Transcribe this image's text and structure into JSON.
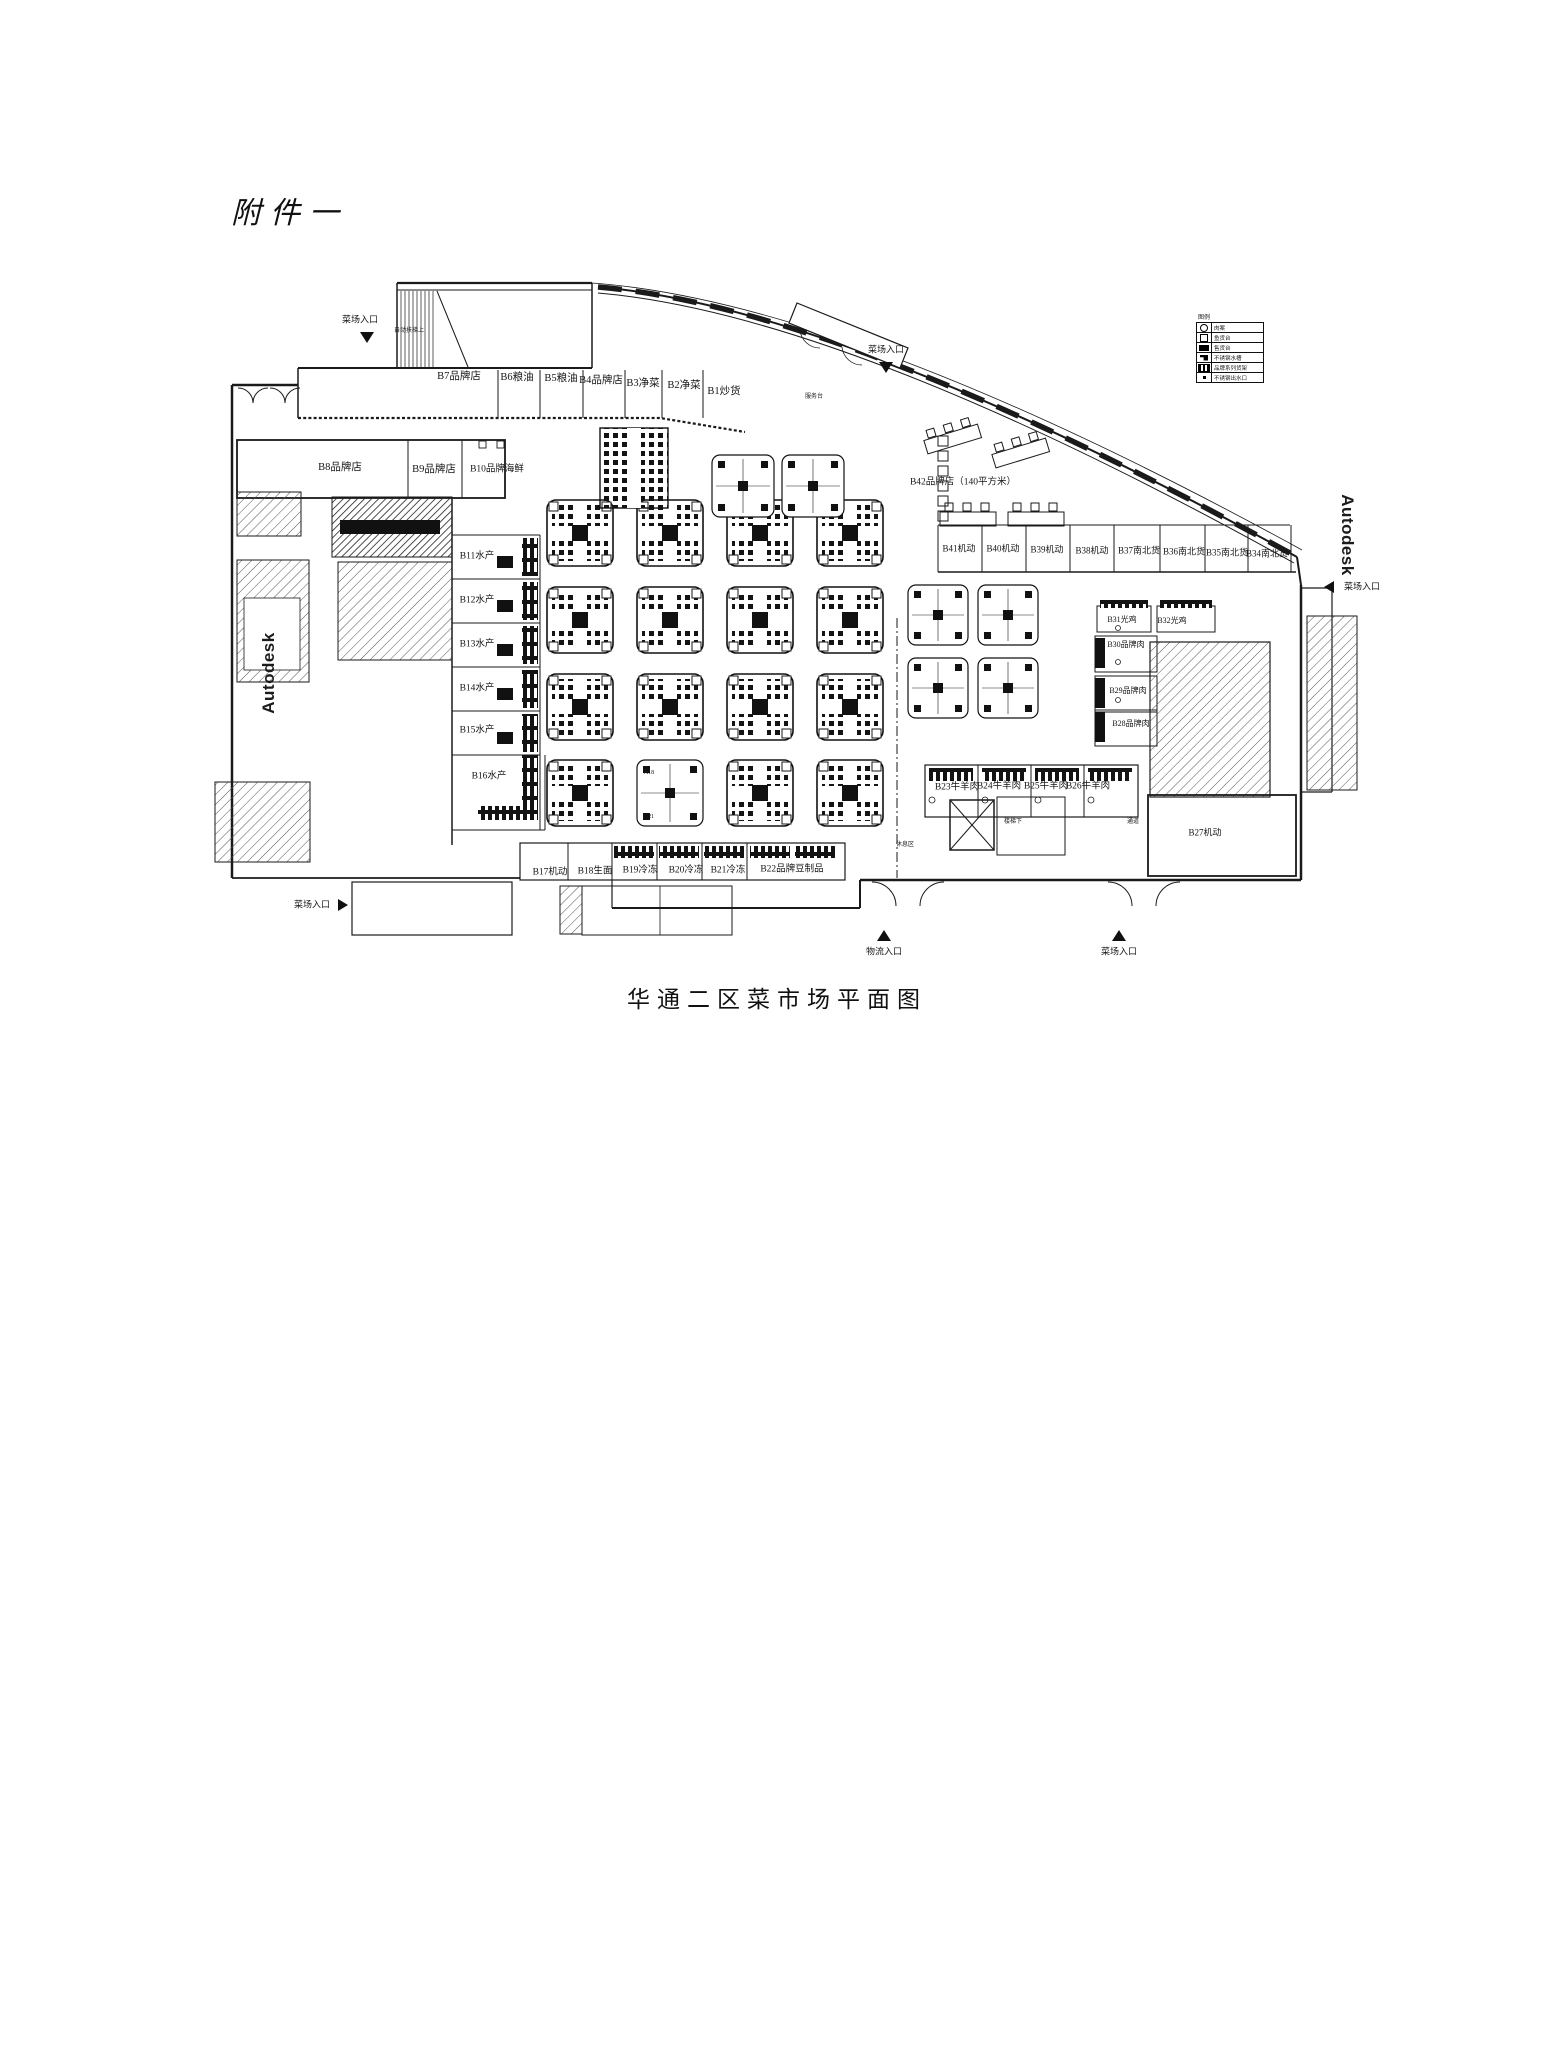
{
  "doc": {
    "attachment_label": "附件一",
    "caption": "华通二区菜市场平面图",
    "watermark": "Autodesk"
  },
  "colors": {
    "ink": "#1a1a1a",
    "paper": "#ffffff"
  },
  "plan": {
    "legend": {
      "title": "图例",
      "rows": [
        {
          "symbol": "circle",
          "label": "肉案"
        },
        {
          "symbol": "square",
          "label": "鱼货台"
        },
        {
          "symbol": "blackbox",
          "label": "售货台"
        },
        {
          "symbol": "flag",
          "label": "不锈钢水槽"
        },
        {
          "symbol": "dots",
          "label": "品牌系列货架"
        },
        {
          "symbol": "dot",
          "label": "不锈钢出水口"
        }
      ]
    },
    "entrances": [
      {
        "label": "菜场入口",
        "lx": 360,
        "ly": 320,
        "tri": "down",
        "tx": 360,
        "ty": 332
      },
      {
        "label": "菜场入口",
        "lx": 886,
        "ly": 350,
        "tri": "down",
        "tx": 879,
        "ty": 362
      },
      {
        "label": "菜场入口",
        "lx": 1362,
        "ly": 587,
        "tri": "left",
        "tx": 1324,
        "ty": 581
      },
      {
        "label": "菜场入口",
        "lx": 312,
        "ly": 905,
        "tri": "right",
        "tx": 338,
        "ty": 899
      },
      {
        "label": "物流入口",
        "lx": 884,
        "ly": 952,
        "tri": "up",
        "tx": 877,
        "ty": 930
      },
      {
        "label": "菜场入口",
        "lx": 1119,
        "ly": 952,
        "tri": "up",
        "tx": 1112,
        "ty": 930
      }
    ],
    "labels": [
      {
        "t": "B7品牌店",
        "x": 459,
        "y": 377,
        "fs": 10.5
      },
      {
        "t": "B6粮油",
        "x": 517,
        "y": 378,
        "fs": 10.5
      },
      {
        "t": "B5粮油",
        "x": 561,
        "y": 379,
        "fs": 10.5
      },
      {
        "t": "B4品牌店",
        "x": 601,
        "y": 381,
        "fs": 10.5
      },
      {
        "t": "B3净菜",
        "x": 643,
        "y": 384,
        "fs": 10.5
      },
      {
        "t": "B2净菜",
        "x": 684,
        "y": 386,
        "fs": 10.5
      },
      {
        "t": "B1炒货",
        "x": 724,
        "y": 392,
        "fs": 10.5
      },
      {
        "t": "B8品牌店",
        "x": 340,
        "y": 468,
        "fs": 10.5
      },
      {
        "t": "B9品牌店",
        "x": 434,
        "y": 470,
        "fs": 10.5
      },
      {
        "t": "B10品牌海鲜",
        "x": 497,
        "y": 470,
        "fs": 9.5
      },
      {
        "t": "B11水产",
        "x": 477,
        "y": 557,
        "fs": 9.5
      },
      {
        "t": "B12水产",
        "x": 477,
        "y": 601,
        "fs": 9.5
      },
      {
        "t": "B13水产",
        "x": 477,
        "y": 645,
        "fs": 9.5
      },
      {
        "t": "B14水产",
        "x": 477,
        "y": 689,
        "fs": 9.5
      },
      {
        "t": "B15水产",
        "x": 477,
        "y": 731,
        "fs": 9.5
      },
      {
        "t": "B16水产",
        "x": 489,
        "y": 777,
        "fs": 9.5
      },
      {
        "t": "B17机动",
        "x": 550,
        "y": 873,
        "fs": 9.5
      },
      {
        "t": "B18生面",
        "x": 595,
        "y": 872,
        "fs": 9.5
      },
      {
        "t": "B19冷冻",
        "x": 640,
        "y": 871,
        "fs": 9.5
      },
      {
        "t": "B20冷冻",
        "x": 686,
        "y": 871,
        "fs": 9.5
      },
      {
        "t": "B21冷冻",
        "x": 728,
        "y": 871,
        "fs": 9.5
      },
      {
        "t": "B22品牌豆制品",
        "x": 792,
        "y": 870,
        "fs": 9.5
      },
      {
        "t": "B42品牌店（140平方米）",
        "x": 963,
        "y": 483,
        "fs": 9.5
      },
      {
        "t": "B41机动",
        "x": 959,
        "y": 549,
        "fs": 9
      },
      {
        "t": "B40机动",
        "x": 1003,
        "y": 549,
        "fs": 9
      },
      {
        "t": "B39机动",
        "x": 1047,
        "y": 550,
        "fs": 9
      },
      {
        "t": "B38机动",
        "x": 1092,
        "y": 551,
        "fs": 9
      },
      {
        "t": "B37南北货",
        "x": 1139,
        "y": 551,
        "fs": 9
      },
      {
        "t": "B36南北货",
        "x": 1184,
        "y": 552,
        "fs": 9
      },
      {
        "t": "B35南北货",
        "x": 1227,
        "y": 553,
        "fs": 9
      },
      {
        "t": "B34南北货",
        "x": 1267,
        "y": 554,
        "fs": 9
      },
      {
        "t": "B31光鸡",
        "x": 1122,
        "y": 620,
        "fs": 8
      },
      {
        "t": "B32光鸡",
        "x": 1172,
        "y": 621,
        "fs": 8
      },
      {
        "t": "B30品牌肉",
        "x": 1126,
        "y": 645,
        "fs": 8
      },
      {
        "t": "B29品牌肉",
        "x": 1128,
        "y": 691,
        "fs": 8
      },
      {
        "t": "B28品牌肉",
        "x": 1131,
        "y": 724,
        "fs": 8
      },
      {
        "t": "B23牛羊肉",
        "x": 957,
        "y": 788,
        "fs": 9.5
      },
      {
        "t": "B24牛羊肉",
        "x": 999,
        "y": 787,
        "fs": 9.5
      },
      {
        "t": "B25牛羊肉",
        "x": 1046,
        "y": 787,
        "fs": 9.5
      },
      {
        "t": "B26牛羊肉",
        "x": 1088,
        "y": 787,
        "fs": 9.5
      },
      {
        "t": "B27机动",
        "x": 1205,
        "y": 833,
        "fs": 9
      },
      {
        "t": "自动扶梯上",
        "x": 409,
        "y": 331,
        "fs": 6
      },
      {
        "t": "服务台",
        "x": 814,
        "y": 397,
        "fs": 6
      },
      {
        "t": "A18",
        "x": 649,
        "y": 773,
        "fs": 6
      },
      {
        "t": "A21",
        "x": 649,
        "y": 817,
        "fs": 6
      },
      {
        "t": "楼梯下",
        "x": 1013,
        "y": 822,
        "fs": 6
      },
      {
        "t": "通道",
        "x": 1133,
        "y": 822,
        "fs": 6
      },
      {
        "t": "休息区",
        "x": 905,
        "y": 845,
        "fs": 6
      }
    ]
  }
}
